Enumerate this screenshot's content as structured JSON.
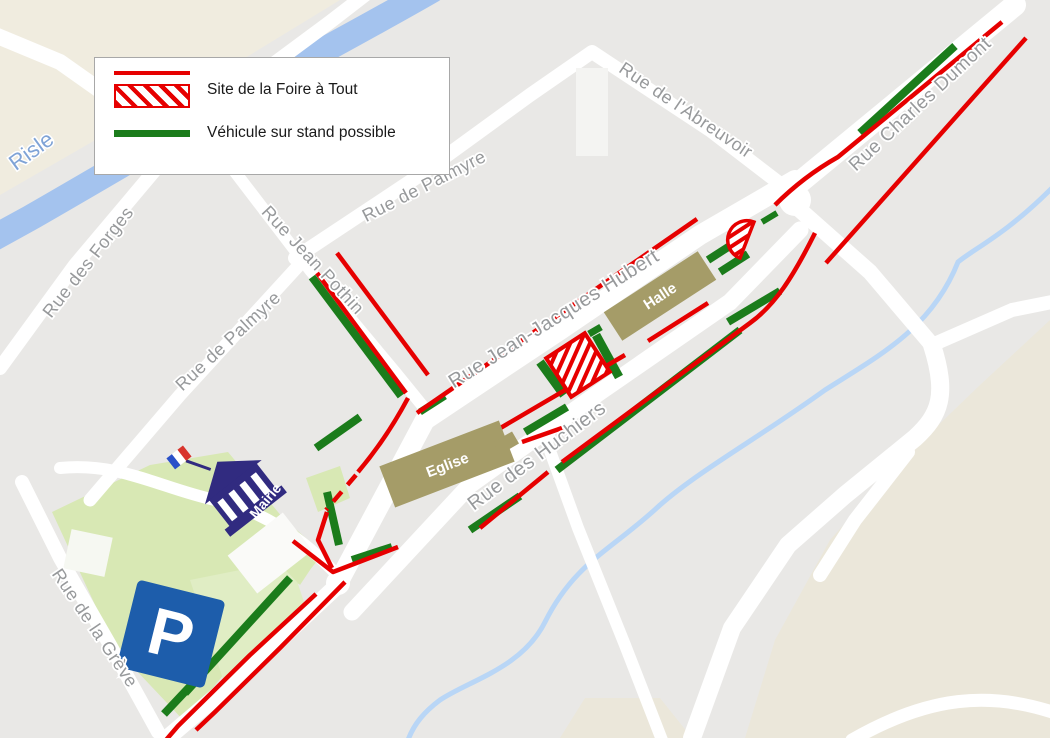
{
  "title": "Plan Foire à Tout",
  "legend": {
    "items": [
      {
        "label": "Site de la Foire à Tout",
        "swatch": "red-line-and-red-hatch"
      },
      {
        "label": "Véhicule sur stand possible",
        "swatch": "green-line"
      }
    ]
  },
  "streets": [
    {
      "id": "forges",
      "name": "Rue des Forges"
    },
    {
      "id": "palmyre-left",
      "name": "Rue de Palmyre"
    },
    {
      "id": "pothin",
      "name": "Rue Jean Pothin"
    },
    {
      "id": "palmyre-top",
      "name": "Rue de Palmyre"
    },
    {
      "id": "abreuvoir",
      "name": "Rue de l'Abreuvoir"
    },
    {
      "id": "dumont",
      "name": "Rue Charles Dumont"
    },
    {
      "id": "hubert",
      "name": "Rue Jean-Jacques Hubert"
    },
    {
      "id": "huchiers",
      "name": "Rue des Huchiers"
    },
    {
      "id": "greve",
      "name": "Rue de la Grève"
    }
  ],
  "river": {
    "name": "Risle"
  },
  "buildings": {
    "halle": "Halle",
    "eglise": "Eglise",
    "mairie": "Mairie"
  },
  "parking": {
    "label": "P"
  },
  "icons": {
    "parking": "parking-icon",
    "mairie": "town-hall-icon",
    "flag": "french-flag-icon"
  },
  "colors": {
    "site_red": "#e60000",
    "stand_green": "#1b7c1b",
    "building_tan": "#a59c68",
    "parking_blue": "#1d5dab",
    "mairie_navy": "#312b80",
    "river_blue": "#a4c3ee",
    "park_green": "#d8e8b4",
    "map_bg": "#e9e8e6"
  }
}
